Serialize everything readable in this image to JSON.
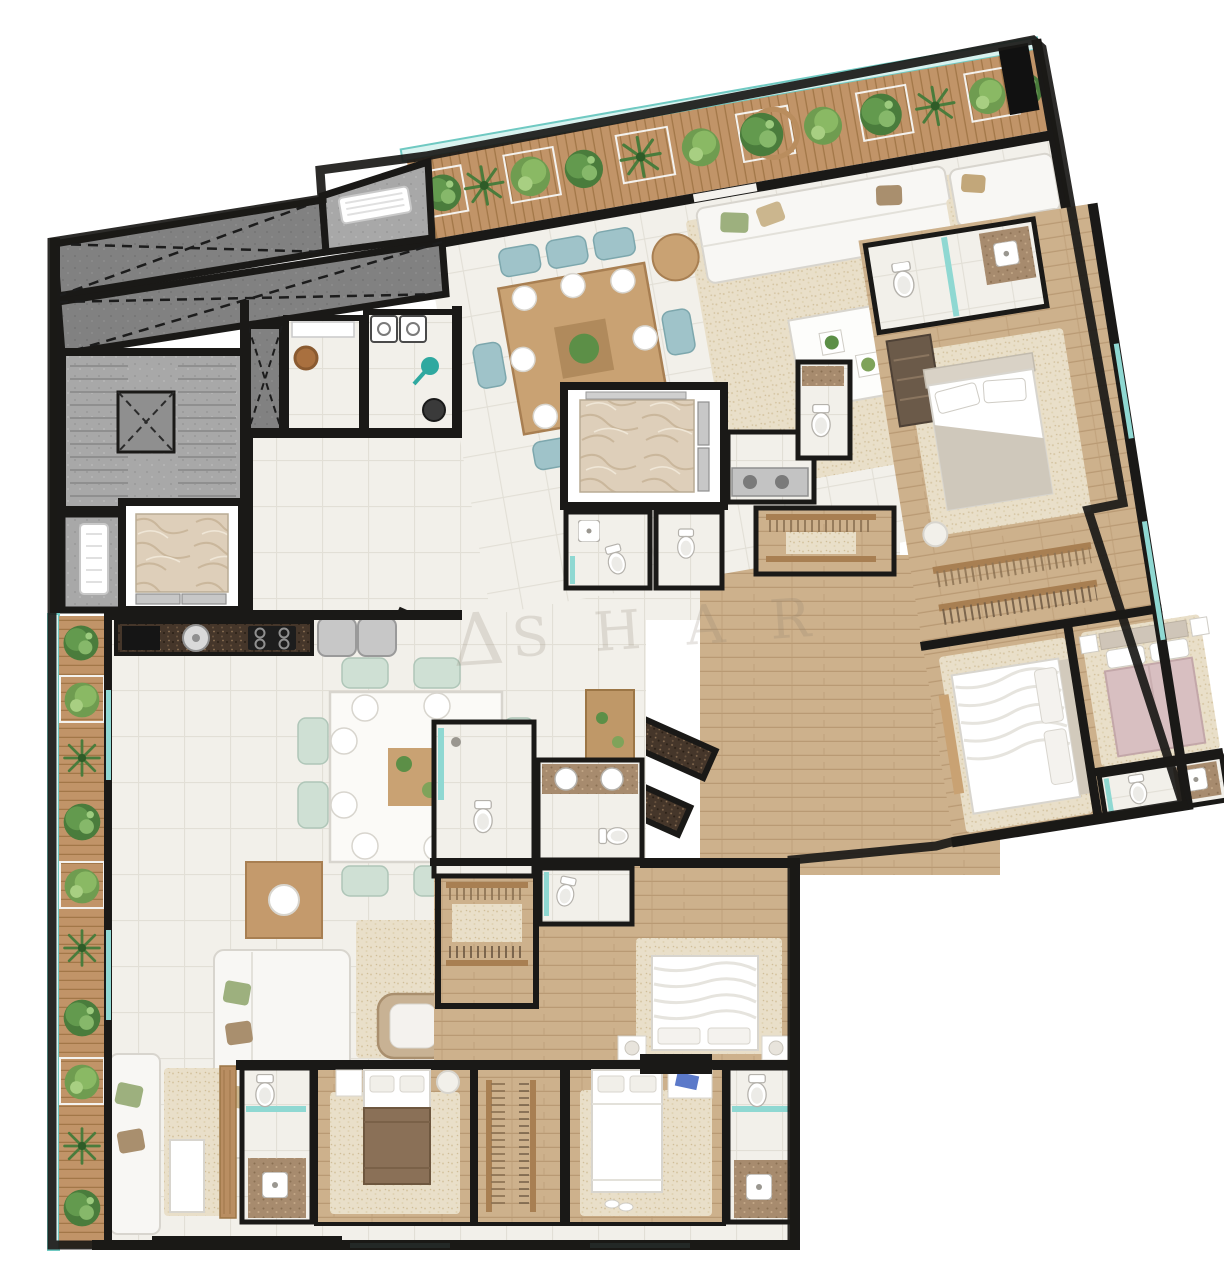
{
  "watermark": {
    "symbol": "Δ",
    "letters": "S H A R"
  },
  "palette": {
    "wall": "#1a1917",
    "tile_floor": "#f2f0ea",
    "tile_line": "#e2dfd6",
    "rug_beige": "#e9dfc9",
    "wood_floor": "#cdb18c",
    "deck_wood": "#c19468",
    "granite_dark": "#45362a",
    "counter_light": "#a78b6e",
    "marble_elevator": "#decfba",
    "concrete_gray": "#a8a8a8",
    "shaft_gray": "#818181",
    "glass_teal": "#8fd8d2",
    "plant_dark": "#4a7c3c",
    "plant_mid": "#6f9c50",
    "plant_light": "#8cbf72",
    "sofa_white": "#f8f7f4",
    "chair_mint": "#cfe0d4",
    "chair_teal": "#9fc3c9",
    "wood_furniture": "#c49a6c",
    "bed_pink": "#d8bfc1",
    "bed_brown": "#8a7057",
    "appliance_silver": "#c7c7c7"
  }
}
